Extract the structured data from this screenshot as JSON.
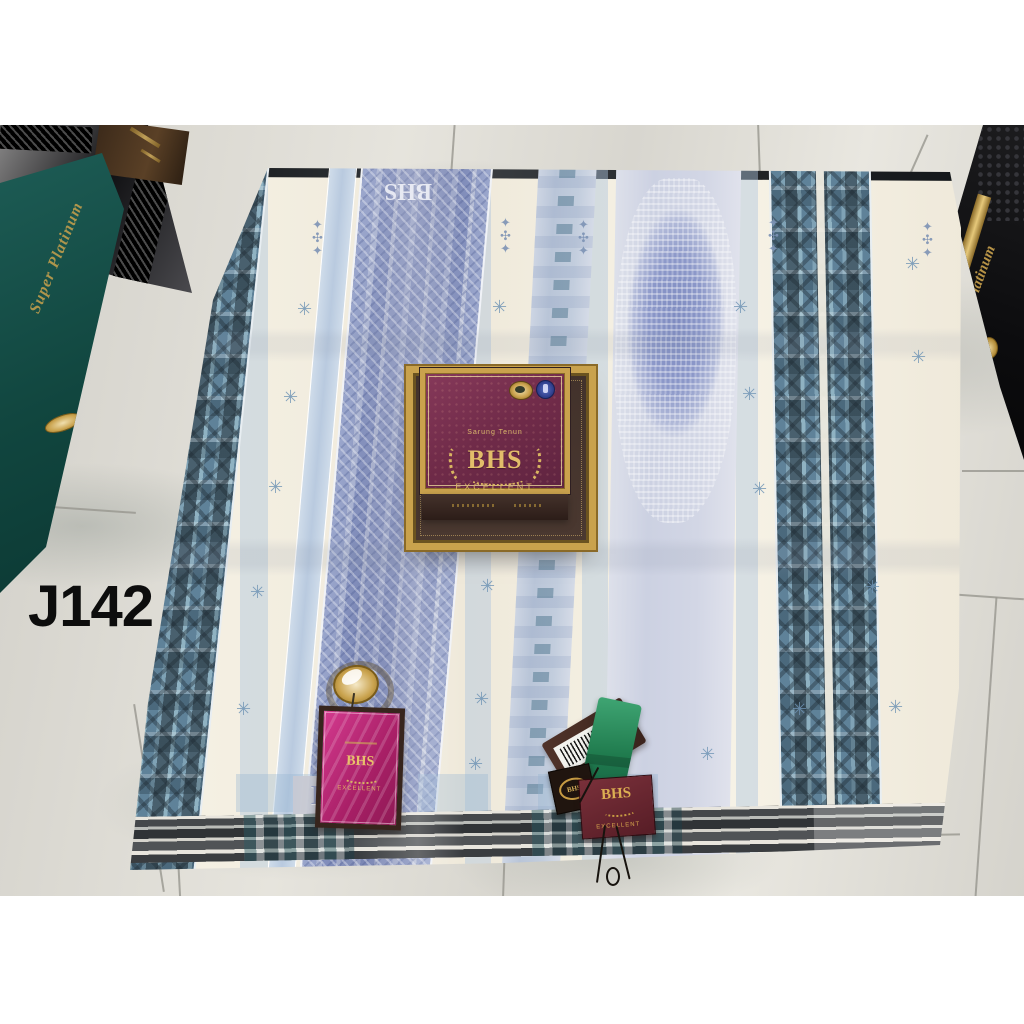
{
  "overlay": {
    "code": "J142"
  },
  "product_box": {
    "category": "Sarung Tenun",
    "brand": "BHS",
    "grade": "EXCELLENT"
  },
  "tags": {
    "pink": {
      "brand": "BHS",
      "grade": "EXCELLENT"
    },
    "maroon": {
      "brand": "BHS",
      "grade": "EXCELLENT"
    },
    "emblem": {
      "brand": "BHS"
    }
  },
  "fabric": {
    "woven_brand_top": "BHS",
    "woven_brand_bottom": "BHS",
    "motifs": {
      "snowflake_glyph": "✳",
      "totem_glyph": "✦✣✦",
      "snowflakes": [
        [
          179,
          132
        ],
        [
          165,
          220
        ],
        [
          150,
          310
        ],
        [
          132,
          415
        ],
        [
          118,
          532
        ],
        [
          374,
          130
        ],
        [
          370,
          222
        ],
        [
          366,
          302
        ],
        [
          362,
          409
        ],
        [
          356,
          522
        ],
        [
          350,
          587
        ],
        [
          615,
          130
        ],
        [
          624,
          217
        ],
        [
          634,
          312
        ],
        [
          582,
          577
        ],
        [
          747,
          410
        ],
        [
          770,
          530
        ],
        [
          674,
          532
        ],
        [
          787,
          87
        ],
        [
          793,
          180
        ]
      ],
      "totems": [
        [
          194,
          50
        ],
        [
          382,
          48
        ],
        [
          460,
          50
        ],
        [
          650,
          48
        ],
        [
          804,
          52
        ]
      ]
    }
  },
  "background_boxes": {
    "teal_label": "Super Platinum",
    "right_label": "Platinum"
  },
  "colors": {
    "magenta_tag": "#c2307f",
    "maroon_box": "#7c3150",
    "gold": "#c9a24d",
    "teal_box": "#12504a",
    "fabric_cream": "#f4f0e3",
    "fabric_periwinkle": "#8fa3cc",
    "fabric_teal_ikat": "#6d93a8",
    "floor_marble": "#dcdad3"
  }
}
